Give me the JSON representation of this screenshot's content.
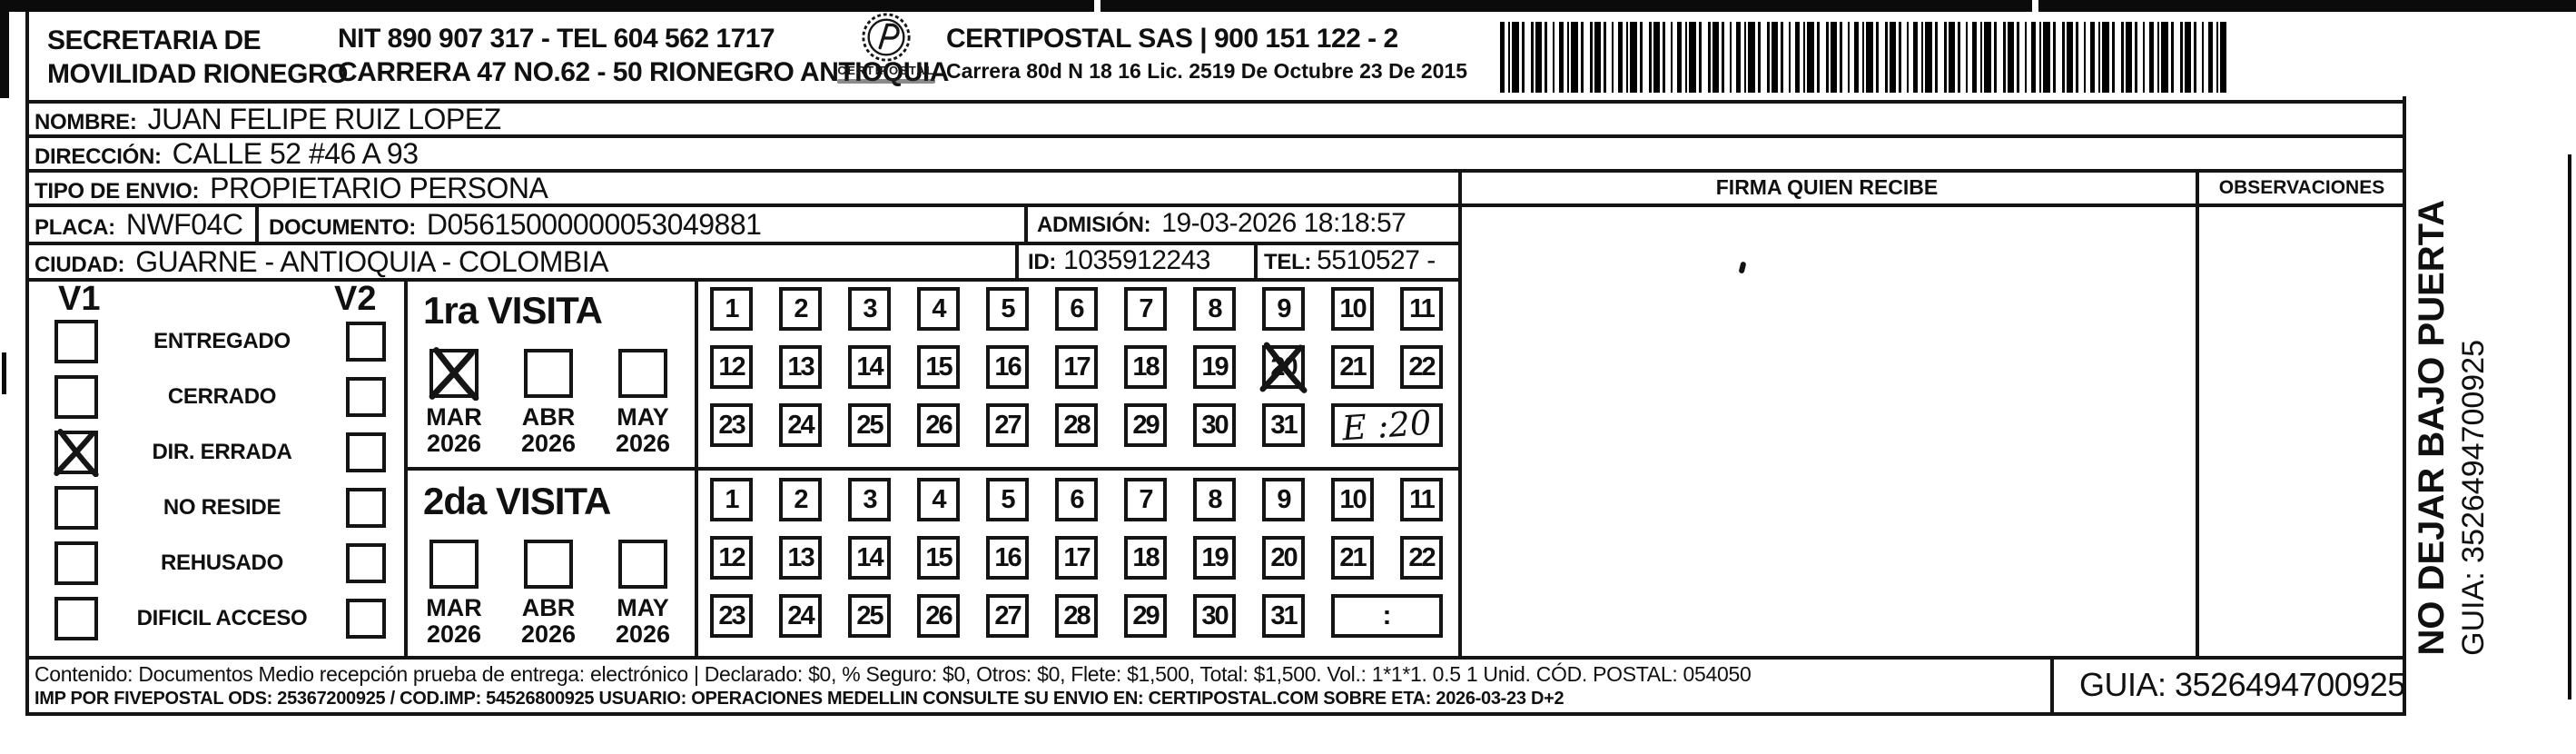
{
  "header": {
    "sender_line1": "SECRETARIA DE",
    "sender_line2": "MOVILIDAD RIONEGRO",
    "nit_tel": "NIT 890 907 317 - TEL 604 562 1717",
    "address": "CARRERA 47 NO.62 - 50 RIONEGRO ANTIOQUIA",
    "logo_text": "CERTIPOSTAL",
    "company": "CERTIPOSTAL SAS | 900 151 122 - 2",
    "company_address": "Carrera 80d N 18 16  Lic. 2519 De Octubre 23 De 2015"
  },
  "recipient": {
    "nombre_label": "NOMBRE:",
    "nombre": "JUAN FELIPE RUIZ LOPEZ",
    "direccion_label": "DIRECCIÓN:",
    "direccion": "CALLE 52 #46 A 93",
    "tipo_label": "TIPO DE ENVIO:",
    "tipo": "PROPIETARIO PERSONA",
    "placa_label": "PLACA:",
    "placa": "NWF04C",
    "documento_label": "DOCUMENTO:",
    "documento": "D05615000000053049881",
    "admision_label": "ADMISIÓN:",
    "admision": "19-03-2026 18:18:57",
    "ciudad_label": "CIUDAD:",
    "ciudad": "GUARNE - ANTIOQUIA - COLOMBIA",
    "id_label": "ID:",
    "id": "1035912243",
    "tel_label": "TEL:",
    "tel": "5510527 -"
  },
  "columns": {
    "firma": "FIRMA QUIEN RECIBE",
    "observaciones": "OBSERVACIONES"
  },
  "status": {
    "v1": "V1",
    "v2": "V2",
    "items": [
      "ENTREGADO",
      "CERRADO",
      "DIR. ERRADA",
      "NO RESIDE",
      "REHUSADO",
      "DIFICIL ACCESO"
    ],
    "v1_checked": "DIR. ERRADA"
  },
  "calendar": {
    "rows": [
      [
        1,
        2,
        3,
        4,
        5,
        6,
        7,
        8,
        9,
        10,
        11
      ],
      [
        12,
        13,
        14,
        15,
        16,
        17,
        18,
        19,
        20,
        21,
        22
      ],
      [
        23,
        24,
        25,
        26,
        27,
        28,
        29,
        30,
        31
      ]
    ]
  },
  "visits": {
    "first": {
      "title": "1ra VISITA",
      "months": [
        "MAR",
        "ABR",
        "MAY"
      ],
      "year": "2026",
      "checked_month": "MAR",
      "crossed_day": 20,
      "time_note": "E :20",
      "handwritten": true
    },
    "second": {
      "title": "2da VISITA",
      "months": [
        "MAR",
        "ABR",
        "MAY"
      ],
      "year": "2026",
      "checked_month": null,
      "crossed_day": null,
      "time_note": ":",
      "handwritten": false
    }
  },
  "footer": {
    "line1": "Contenido: Documentos Medio recepción prueba de entrega: electrónico | Declarado: $0, % Seguro: $0, Otros: $0, Flete: $1,500, Total: $1,500. Vol.: 1*1*1. 0.5  1 Unid. CÓD. POSTAL: 054050",
    "line2": "IMP POR FIVEPOSTAL ODS: 25367200925 / COD.IMP: 54526800925 USUARIO: OPERACIONES MEDELLIN CONSULTE SU ENVIO EN: CERTIPOSTAL.COM SOBRE ETA: 2026-03-23 D+2",
    "guia": "GUIA: 3526494700925"
  },
  "side": {
    "warning": "NO DEJAR BAJO PUERTA",
    "guia": "GUIA: 3526494700925"
  }
}
